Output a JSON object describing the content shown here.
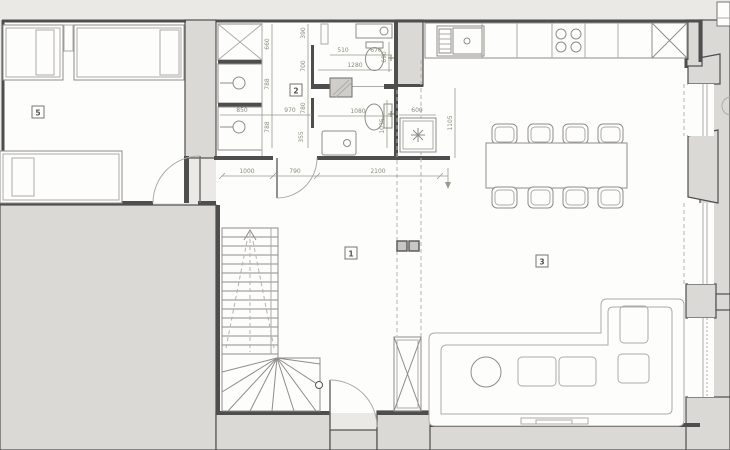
{
  "rooms": {
    "bedroom": "5",
    "bathroom": "2",
    "hall": "1",
    "living": "3"
  },
  "dims": {
    "d660": "660",
    "d788a": "788",
    "d788b": "788",
    "d850": "850",
    "d970": "970",
    "d390": "390",
    "d700": "700",
    "d780": "780",
    "d355": "355",
    "d510": "510",
    "d670": "670",
    "d1280": "1280",
    "d690": "690",
    "d1080": "1080",
    "d1035": "1035",
    "d600": "600",
    "d1105": "1105",
    "d1000": "1000",
    "d790": "790",
    "d2100": "2100"
  },
  "colors": {
    "background": "#ebe9e6",
    "paper": "#fdfdfc",
    "wall_fill": "#dbd9d5",
    "line_dark": "#4e4e4e",
    "line_light": "#aeaca8",
    "dim_text": "#8b8b7b"
  },
  "icons": {
    "wardrobe_x": "x-cross",
    "drain_star": "asterisk",
    "center_mark": "plus"
  }
}
